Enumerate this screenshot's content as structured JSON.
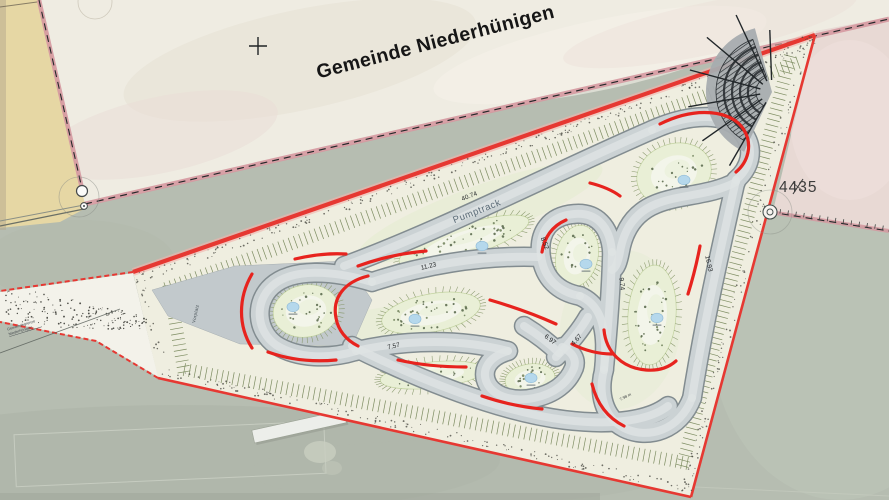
{
  "plan": {
    "municipality_label": "Gemeinde Niederhünigen",
    "track_label": "Pumptrack",
    "main_dimension": "40.74",
    "dimension_labels": [
      "8.52",
      "11.23",
      "7.57",
      "6.97",
      "4.67",
      "9.74",
      "16.93"
    ],
    "small_dimension": "7.98 m",
    "parcel_number": "4435",
    "plaza_label": "Vorplatz",
    "boundary_annotation": {
      "line1": "Gemeindegrenze",
      "line2": "Niederhünigen"
    },
    "colors": {
      "boundary_red": "#e63832",
      "berm_red": "#e7231e",
      "municipal_pink": "#d598a0",
      "track_gray": "#cbd2d4",
      "track_edge": "#828c90",
      "island_green": "#e9efd6",
      "pond_blue": "#b5d8ec",
      "parcel_yellow": "#e6d7a4",
      "gravel_cream": "#efeee0",
      "grass": "#b6bdb1",
      "survey_ink": "#3d3d3c"
    }
  }
}
